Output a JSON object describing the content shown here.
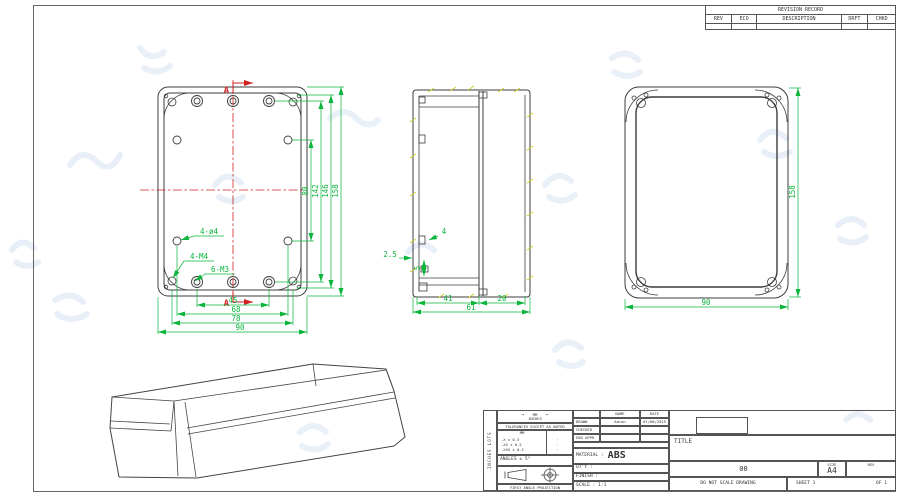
{
  "colors": {
    "line": "#3c3c3c",
    "dimension": "#0ab53c",
    "section_mark": "#cf2121",
    "hatch_tick": "#cfcf2e",
    "watermark": "#d3e1f2"
  },
  "revision_table": {
    "title": "REVISION RECORD",
    "columns": [
      "REV",
      "ECO",
      "DESCRIPTION",
      "DRFT",
      "CHKD"
    ]
  },
  "front_view": {
    "section_letter_top": "A",
    "section_letter_bottom": "A",
    "dims_vertical": [
      "80",
      "142",
      "146",
      "158"
    ],
    "dims_bottom": [
      "45",
      "68",
      "78",
      "90"
    ],
    "callouts": [
      "4-ø4",
      "4-M4",
      "6-M3"
    ]
  },
  "side_view": {
    "dim_tab": "4",
    "dim_lip": "2.5",
    "dim_step": "5",
    "dim_body": "41",
    "dim_lid": "20",
    "dim_total": "61"
  },
  "back_view": {
    "dim_height": "158",
    "dim_width": "90"
  },
  "title_block": {
    "side_label": "INCHES LOTS",
    "units_arrows": [
      "→",
      "←"
    ],
    "units_top": "MM",
    "units_bottom": "INCHES",
    "tolerances_note": "TOLERANCES EXCEPT AS NOTED",
    "tol_unit_header": "MM",
    "tol_rows": [
      {
        "mm": ".X ± 0.3",
        "in": "·"
      },
      {
        "mm": ".XX ± 0.2",
        "in": "·"
      },
      {
        "mm": ".XXX ± 0.1",
        "in": "·"
      }
    ],
    "angles": "ANGLES ± 5°",
    "projection_label": "FIRST ANGLE PROJECTION",
    "name_header": "NAME",
    "date_header": "DATE",
    "drawn_label": "DRAWN",
    "drawn_name": "Aaron",
    "drawn_date": "01/08/2015",
    "checked_label": "CHECKED",
    "eng_appr_label": "ENG APPR",
    "material_label": "MATERIAL :",
    "material_value": "ABS",
    "qty_label": "QT'Y :",
    "finish_label": "FINISH :",
    "scale_label": "SCALE : 1:1",
    "title_label": "TITLE",
    "drawing_number": "00",
    "size_label": "SIZE",
    "size_value": "A4",
    "rev_label": "REV",
    "do_not_scale": "DO NOT SCALE DRAWING",
    "sheet_label": "SHEET 1",
    "of_label": "OF 1"
  }
}
